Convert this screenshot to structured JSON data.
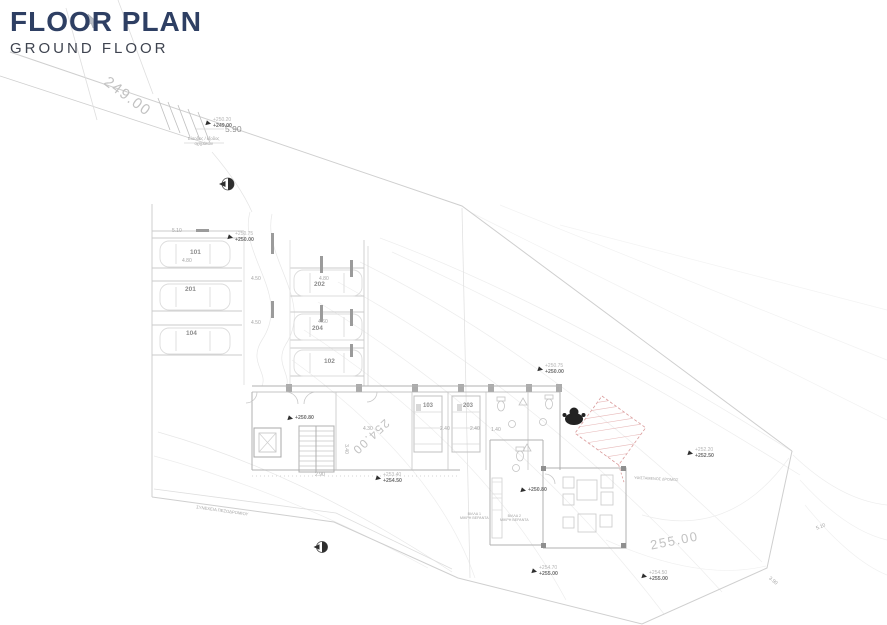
{
  "header": {
    "title": "FLOOR PLAN",
    "subtitle": "GROUND FLOOR"
  },
  "colors": {
    "title": "#2e3f63",
    "subtitle": "#3f4450",
    "accent_red": "#d98f8f",
    "line": "#cfcfcf"
  },
  "plan": {
    "contours": [
      "249.00",
      "254.00",
      "255.00"
    ],
    "stalls": [
      "101",
      "201",
      "104",
      "202",
      "204",
      "102"
    ],
    "rooms": [
      "103",
      "203"
    ],
    "dims": [
      "5.90",
      "5.10",
      "4.80",
      "4.50",
      "4.80",
      "4.50",
      "4.60",
      "4.30",
      "2.40",
      "2.40",
      "1.40",
      "3.40",
      "2.90",
      "5.10",
      "3.90"
    ],
    "levels": [
      {
        "upper": "+250.20",
        "lower": "+249.00"
      },
      {
        "upper": "+250.75",
        "lower": "+250.00"
      },
      {
        "upper": "+250.75",
        "lower": "+250.00"
      },
      {
        "lower": "+250.80"
      },
      {
        "upper": "+253.40",
        "lower": "+254.50"
      },
      {
        "lower": "+250.80"
      },
      {
        "upper": "+252.20",
        "lower": "+252.50"
      },
      {
        "upper": "+254.70",
        "lower": "+255.00"
      },
      {
        "upper": "+254.50",
        "lower": "+255.00"
      }
    ],
    "annotations": {
      "entrance_line1": "Είσοδος / έξοδος",
      "entrance_line2": "οχημάτων",
      "sidewalk": "ΣΥΝΕΧΕΙΑ ΠΕΖΟΔΡΟΜΙΟΥ",
      "road": "ΥΦΙΣΤΑΜΕΝΟΣ ΔΡΟΜΟΣ",
      "villa1_line1": "ΒΙΛΛΑ 1",
      "villa1_line2": "ΜΙΚΡΗ ΒΕΡΑΝΤΑ",
      "villa2_line1": "ΒΙΛΛΑ 2",
      "villa2_line2": "ΜΙΚΡΗ ΒΕΡΑΝΤΑ"
    }
  }
}
